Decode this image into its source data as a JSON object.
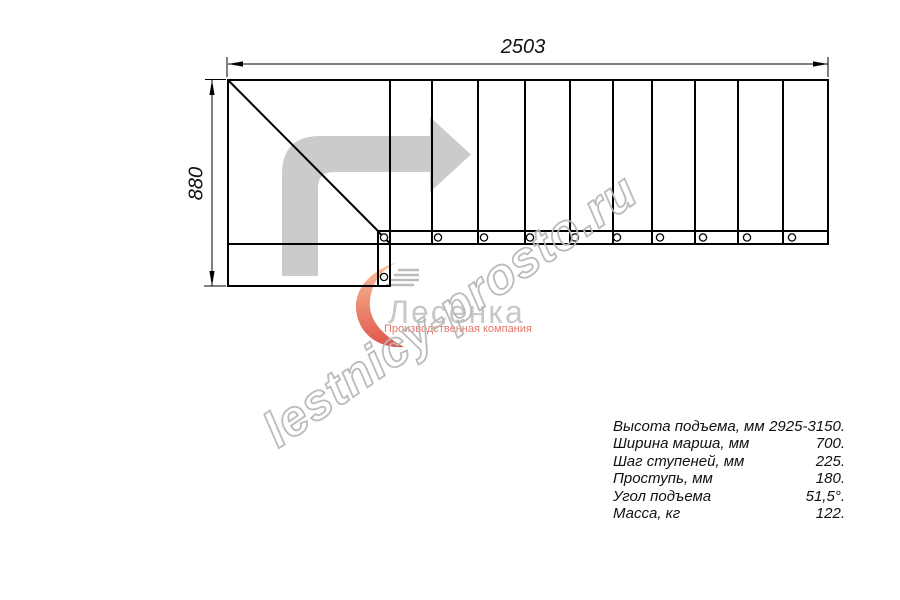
{
  "dimensions": {
    "width_mm": "2503",
    "height_mm": "880"
  },
  "specs": {
    "rows": [
      {
        "label": "Высота подъема, мм",
        "value": "2925-3150."
      },
      {
        "label": "Ширина марша, мм",
        "value": "700."
      },
      {
        "label": "Шаг ступеней, мм",
        "value": "225."
      },
      {
        "label": "Проступь, мм",
        "value": "180."
      },
      {
        "label": "Угол подъема",
        "value": "51,5°."
      },
      {
        "label": "Масса, кг",
        "value": "122."
      }
    ]
  },
  "watermark": {
    "text": "lestnicy-prosto.ru"
  },
  "logo": {
    "name": "Лесенка",
    "tagline": "Производственная компания"
  },
  "colors": {
    "line": "#000000",
    "direction_arrow": "#cbcbcb",
    "watermark": "#b8b8b8",
    "logo_text": "#c8c8c8",
    "logo_tagline": "#e2776b",
    "swoosh_top": "#f8c49c",
    "swoosh_bottom": "#e0544a"
  }
}
